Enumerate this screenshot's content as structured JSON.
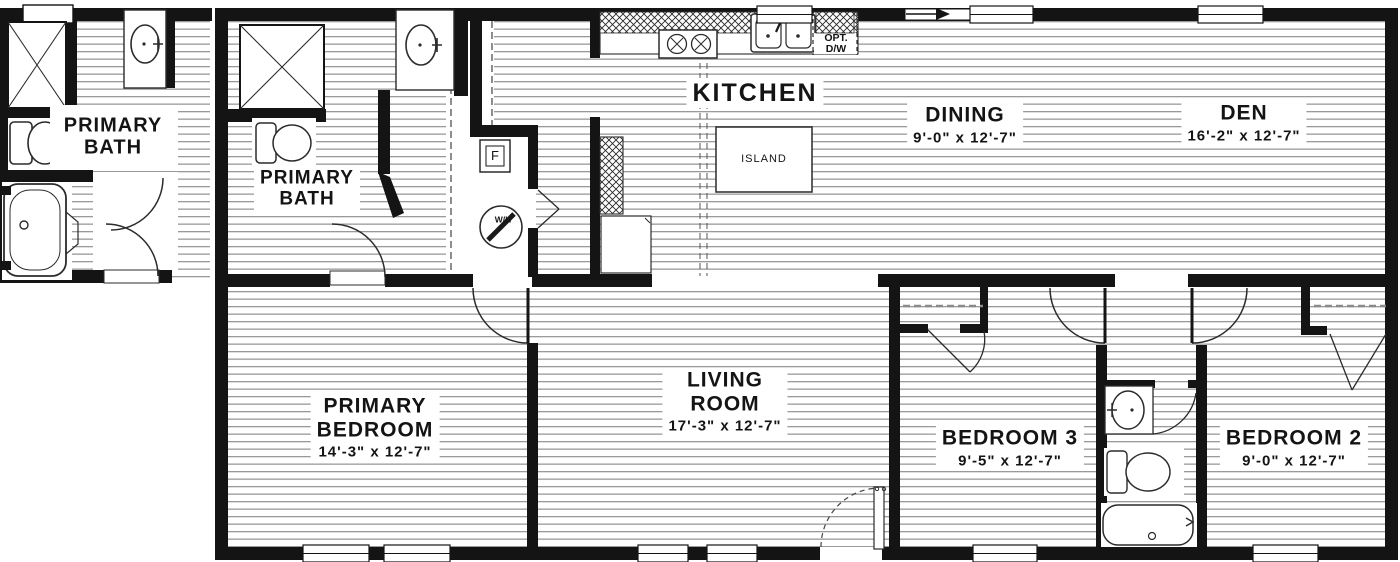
{
  "title": "Floor plan",
  "colors": {
    "wall": "#141414",
    "floor_line": "#9a9a9a",
    "fixture_stroke": "#2b2b2b"
  },
  "detail_inset": {
    "room_line1": "PRIMARY",
    "room_line2": "BATH"
  },
  "rooms": {
    "primary_bath": {
      "line1": "PRIMARY",
      "line2": "BATH"
    },
    "kitchen": {
      "name": "KITCHEN"
    },
    "dining": {
      "name": "DINING",
      "dims": "9'-0\" x 12'-7\""
    },
    "den": {
      "name": "DEN",
      "dims": "16'-2\" x 12'-7\""
    },
    "primary_bedroom": {
      "line1": "PRIMARY",
      "line2": "BEDROOM",
      "dims": "14'-3\" x 12'-7\""
    },
    "living_room": {
      "line1": "LIVING",
      "line2": "ROOM",
      "dims": "17'-3\" x 12'-7\""
    },
    "bedroom3": {
      "name": "BEDROOM 3",
      "dims": "9'-5\" x 12'-7\""
    },
    "bedroom2": {
      "name": "BEDROOM 2",
      "dims": "9'-0\" x 12'-7\""
    }
  },
  "fixtures": {
    "island": "ISLAND",
    "furnace": "F",
    "water_heater": "W/H",
    "opt_dw_line1": "OPT.",
    "opt_dw_line2": "D/W"
  }
}
